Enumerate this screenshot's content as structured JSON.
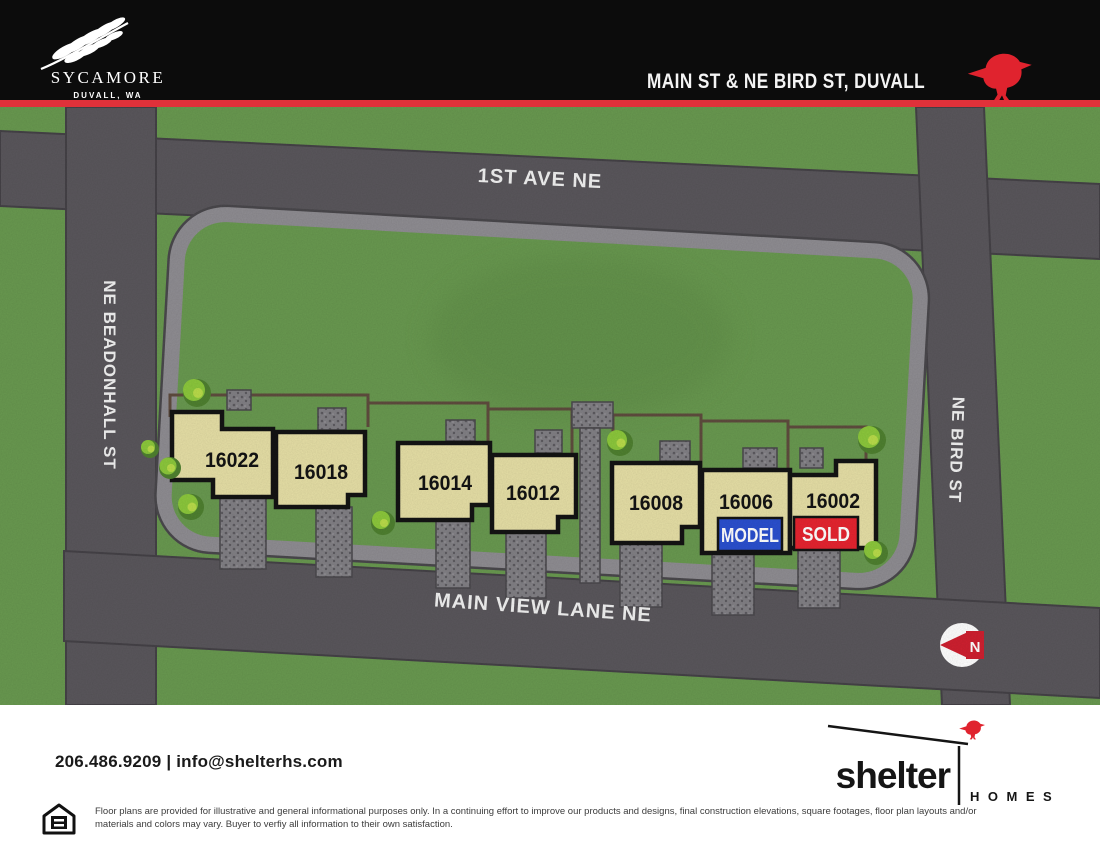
{
  "header": {
    "community": "SYCAMORE",
    "community_city": "DUVALL, WA",
    "crossroads": "MAIN ST & NE BIRD ST, DUVALL"
  },
  "map": {
    "streets": {
      "top": "1ST AVE NE",
      "left": "NE BEADONHALL ST",
      "right": "NE BIRD ST",
      "bottom": "MAIN VIEW LANE NE"
    },
    "compass_label": "N",
    "lots": [
      {
        "number": "16022",
        "status": "available"
      },
      {
        "number": "16018",
        "status": "available"
      },
      {
        "number": "16014",
        "status": "available"
      },
      {
        "number": "16012",
        "status": "available"
      },
      {
        "number": "16008",
        "status": "available"
      },
      {
        "number": "16006",
        "status": "model",
        "banner": "MODEL"
      },
      {
        "number": "16002",
        "status": "sold",
        "banner": "SOLD"
      }
    ]
  },
  "footer": {
    "contact_line": "206.486.9209 | info@shelterhs.com",
    "builder_name": "shelter",
    "builder_type": "HOMES",
    "disclaimer": "Floor plans are provided for illustrative and general informational purposes only. In a continuing effort to improve our products and designs, final construction elevations, square footages, floor plan layouts and/or materials and colors may vary. Buyer to verfiy all information to their own satisfaction."
  },
  "colors": {
    "header_stripe": "#e0313a",
    "bird_red": "#e0232e",
    "grass": "#699950",
    "road": "#5a575c",
    "sidewalk": "#8f8d92",
    "house_fill": "#e6dfa6",
    "model_blue": "#2b50cf",
    "sold_red": "#e62430"
  }
}
